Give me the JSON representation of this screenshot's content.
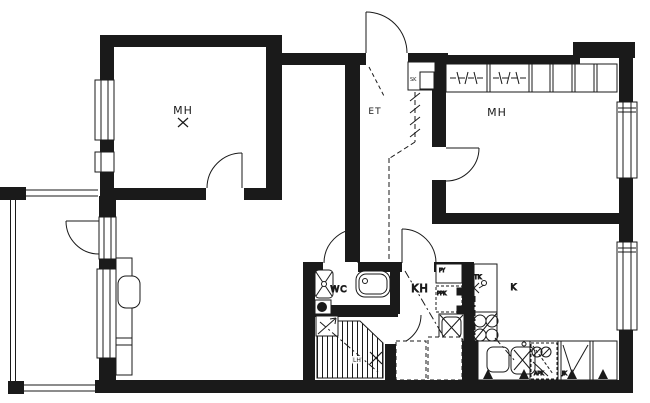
{
  "labels": {
    "bedroom1": "MH",
    "bedroom2": "MH",
    "hallway": "ET",
    "closet_sk": "SK",
    "wc": "WC",
    "bathroom_kh": "KH",
    "sauna_lh": "LH",
    "kitchen_k": "K",
    "washing_py": "PY",
    "washer_ppk": "PPK",
    "drying_tk": "TK",
    "dishwasher_apk": "APK",
    "fridge_jk": "JK"
  }
}
